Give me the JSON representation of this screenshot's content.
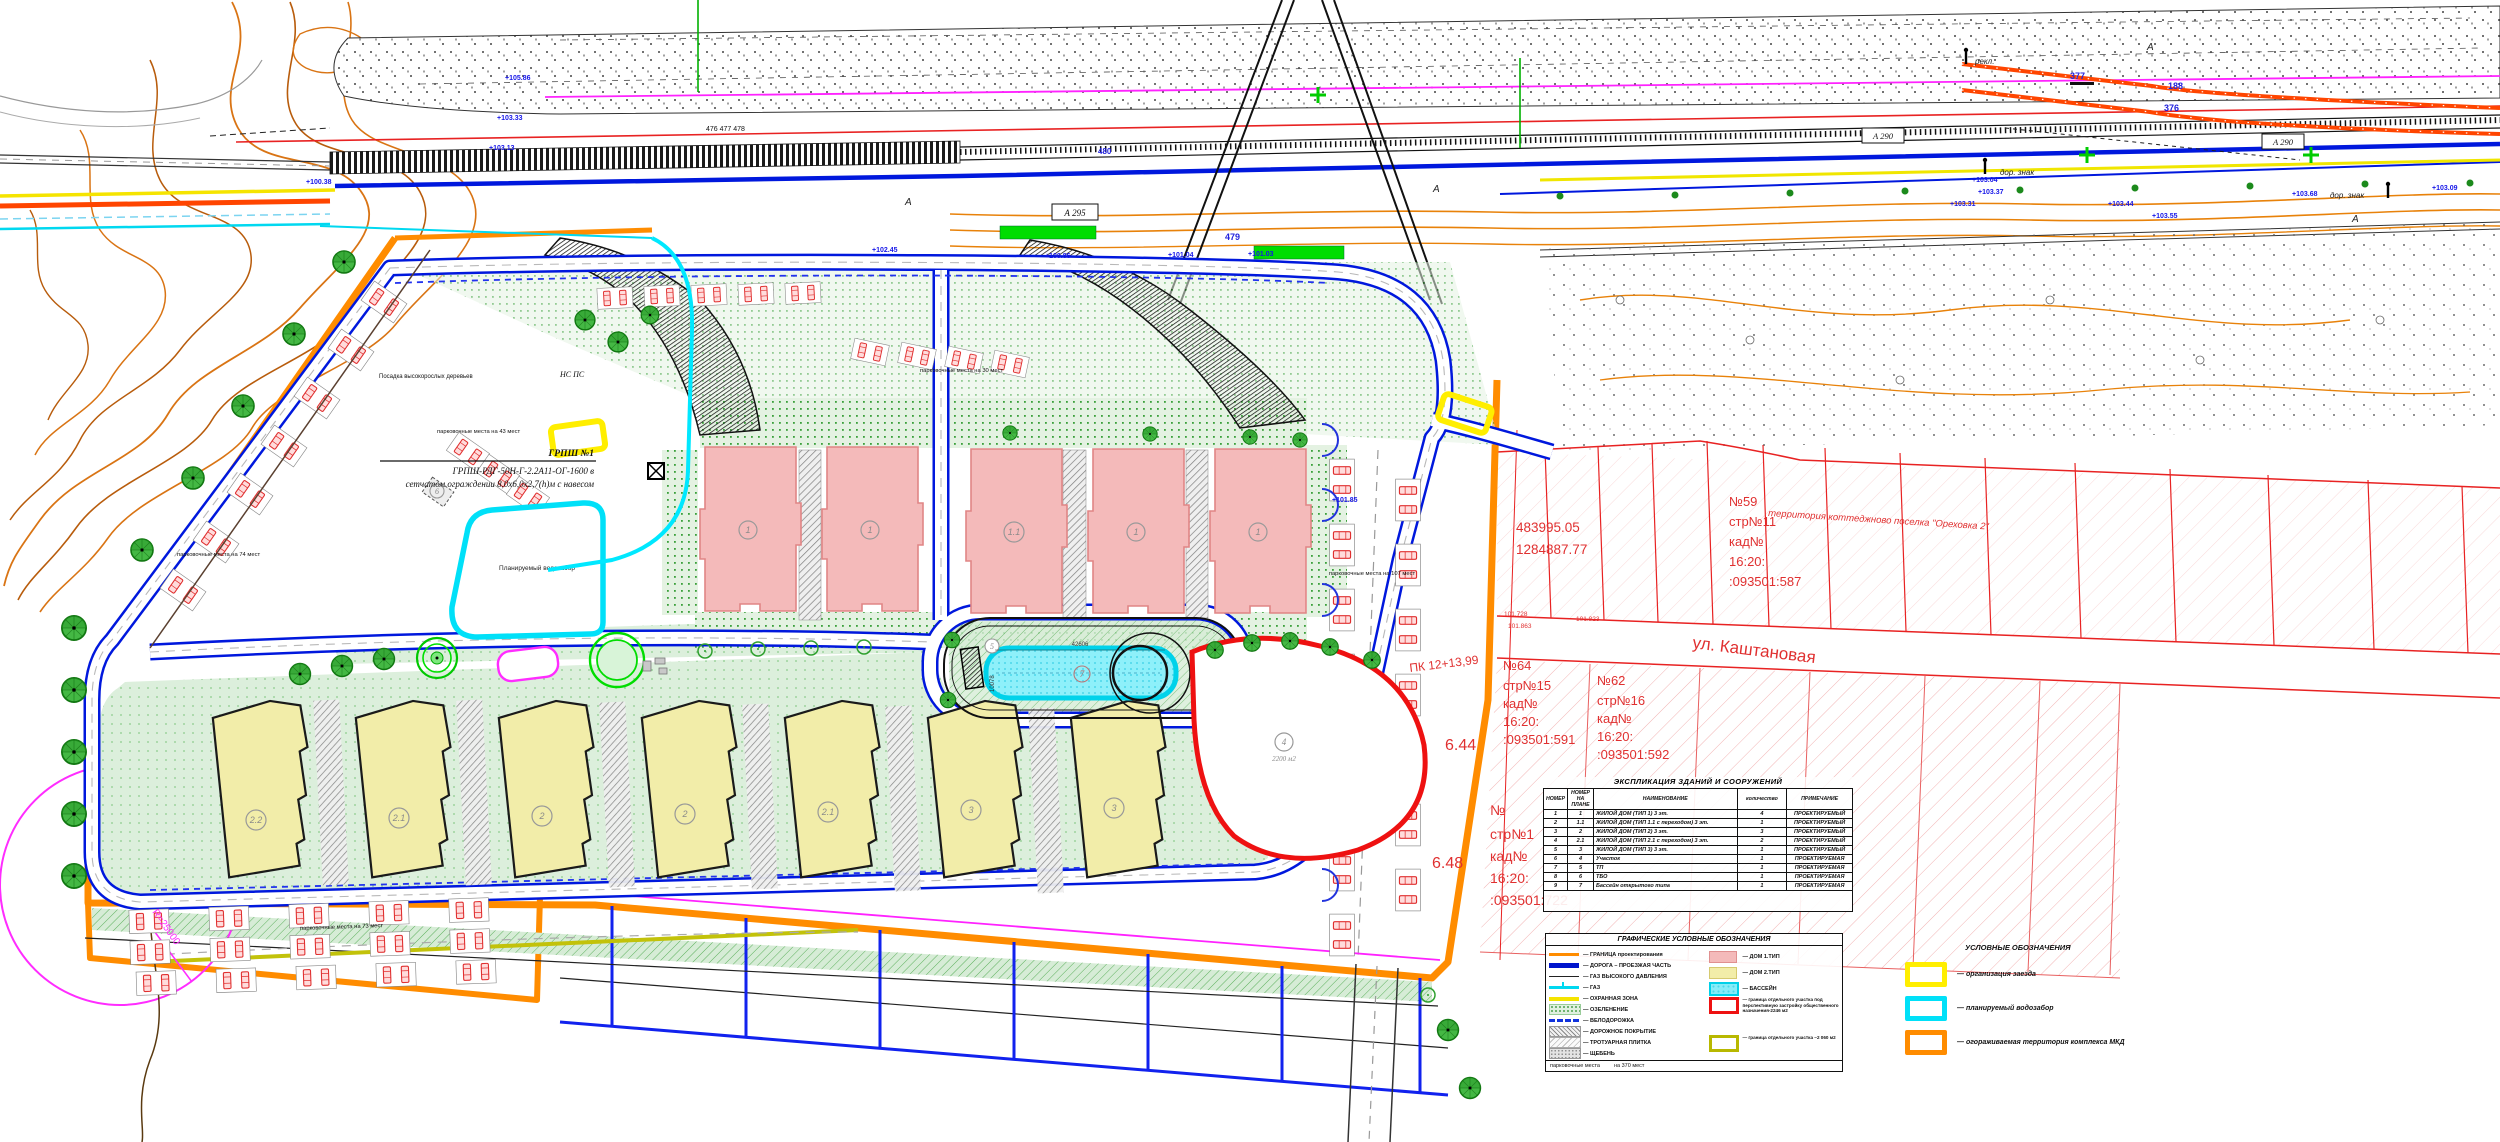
{
  "map": {
    "labels": {
      "grpsh_title": "ГРПШ №1",
      "grpsh_line2": "ГРПШ-РДГ-50Н-Г-2.2А11-ОГ-1600 в",
      "grpsh_line3": "сетчатом ограждении 8,0х6,0х2,7(h)м с навесом",
      "planting": "Посадка высокорослых деревьев",
      "ns_ps": "НС ПС",
      "vodozabor": "Планируемый водозабор",
      "parking_74": "парковочные места на 74 мест",
      "parking_73": "парковочные места на 73 мест",
      "parking_107": "парковочные места на 107 мест",
      "parking_43": "парковочные места на 43 мест",
      "parking_30": "парковочные места на 30 мест",
      "street": "ул. Каштановая",
      "territory": "территория коттеджново поселка \"Ореховка 2\"",
      "coord_n": "483995.05",
      "coord_e": "1284887.77",
      "pk": "ПК 12+13,99",
      "radius": "R=25000",
      "area_2200": "2200 м2",
      "pool_len": "42606",
      "pool_wid": "10078",
      "mark_644": "6.44",
      "mark_648": "6.48",
      "road_box_a295": "А 295",
      "road_box_a290": "А 290",
      "pile_479": "479",
      "pile_480": "480",
      "pile_476": "476 477 478",
      "n377": "377",
      "n376": "376",
      "n188": "188",
      "dor_znak": "дор. знак",
      "rekl": "рекл.",
      "letter_a": "А",
      "red_101_728": "101.728",
      "red_101_863": "101.863",
      "red_101_823": "101.823"
    },
    "elevations": [
      "+103.33",
      "+105.86",
      "+103.13",
      "+100.38",
      "+101.85",
      "+103.04",
      "+103.37",
      "+103.31",
      "+101.04",
      "+101.03",
      "+100.86",
      "+103.44",
      "+103.55",
      "+102.45",
      "+103.68",
      "+103.09"
    ],
    "parcels": {
      "p59": [
        "№59",
        "стр№11",
        "кад№",
        "16:20:",
        ":093501:587"
      ],
      "p64": [
        "№64",
        "стр№15",
        "кад№",
        "16:20:",
        ":093501:591"
      ],
      "p62": [
        "№62",
        "стр№16",
        "кад№",
        "16:20:",
        ":093501:592"
      ],
      "p722": [
        "№",
        "стр№1",
        "кад№",
        "16:20:",
        ":093501:722"
      ]
    },
    "building_labels": {
      "pink": [
        "1",
        "1",
        "1.1",
        "1",
        "1"
      ],
      "yellow": [
        "2.2",
        "2.1",
        "2",
        "2",
        "2.1",
        "3",
        "3"
      ],
      "pool": "7",
      "site": "4",
      "tp": "5",
      "tbo": "6"
    }
  },
  "table": {
    "title": "ЭКСПЛИКАЦИЯ ЗДАНИЙ И СООРУЖЕНИЙ",
    "headers": [
      "НОМЕР",
      "НОМЕР НА ПЛАНЕ",
      "НАИМЕНОВАНИЕ",
      "количество",
      "ПРИМЕЧАНИЕ"
    ],
    "rows": [
      [
        "1",
        "1",
        "ЖИЛОЙ ДОМ (ТИП 1) 3 эт.",
        "4",
        "ПРОЕКТИРУЕМЫЙ"
      ],
      [
        "2",
        "1.1",
        "ЖИЛОЙ ДОМ (ТИП 1.1 с переходом) 3 эт.",
        "1",
        "ПРОЕКТИРУЕМЫЙ"
      ],
      [
        "3",
        "2",
        "ЖИЛОЙ ДОМ (ТИП 2) 3 эт.",
        "3",
        "ПРОЕКТИРУЕМЫЙ"
      ],
      [
        "4",
        "2.1",
        "ЖИЛОЙ ДОМ (ТИП 2.1 с переходом) 3 эт.",
        "2",
        "ПРОЕКТИРУЕМЫЙ"
      ],
      [
        "5",
        "3",
        "ЖИЛОЙ ДОМ (ТИП 3) 3 эт.",
        "1",
        "ПРОЕКТИРУЕМЫЙ"
      ],
      [
        "6",
        "4",
        "Участок",
        "1",
        "ПРОЕКТИРУЕМАЯ"
      ],
      [
        "7",
        "5",
        "ТП",
        "1",
        "ПРОЕКТИРУЕМАЯ"
      ],
      [
        "8",
        "6",
        "ТБО",
        "1",
        "ПРОЕКТИРУЕМАЯ"
      ],
      [
        "9",
        "7",
        "Бассейн открытого типа",
        "1",
        "ПРОЕКТИРУЕМАЯ"
      ]
    ]
  },
  "legend_graphic": {
    "title": "ГРАФИЧЕСКИЕ УСЛОВНЫЕ ОБОЗНАЧЕНИЯ",
    "items_left": [
      {
        "label": "ГРАНИЦА проектирования"
      },
      {
        "label": "ДОРОГА – ПРОЕЗЖАЯ ЧАСТЬ"
      },
      {
        "label": "ГАЗ ВЫСОКОГО ДАВЛЕНИЯ"
      },
      {
        "label": "ГАЗ"
      },
      {
        "label": "ОХРАННАЯ ЗОНА"
      },
      {
        "label": "ОЗЕЛЕНЕНИЕ"
      },
      {
        "label": "ВЕЛОДОРОЖКА"
      },
      {
        "label": "ДОРОЖНОЕ ПОКРЫТИЕ"
      },
      {
        "label": "ТРОТУАРНАЯ ПЛИТКА"
      },
      {
        "label": "ЩЕБЕНЬ"
      }
    ],
    "items_right": [
      {
        "label": "ДОМ 1.ТИП"
      },
      {
        "label": "ДОМ 2.ТИП"
      },
      {
        "label": "БАССЕЙН"
      },
      {
        "label": "граница отдельного участка под перспективную застройку общественного назначения-2246 м2"
      },
      {
        "label": "граница отдельного участка ~2 060 м2"
      }
    ],
    "footer_left": "парковочные места",
    "footer_right": "на 370 мест"
  },
  "legend_simple": {
    "title": "УСЛОВНЫЕ ОБОЗНАЧЕНИЯ",
    "items": [
      {
        "color": "#ffee00",
        "label": "организация заезда"
      },
      {
        "color": "#00e0f8",
        "label": "планируемый водозабор"
      },
      {
        "color": "#ff8c00",
        "label": "огораживаемая территория комплекса МКД"
      }
    ]
  }
}
